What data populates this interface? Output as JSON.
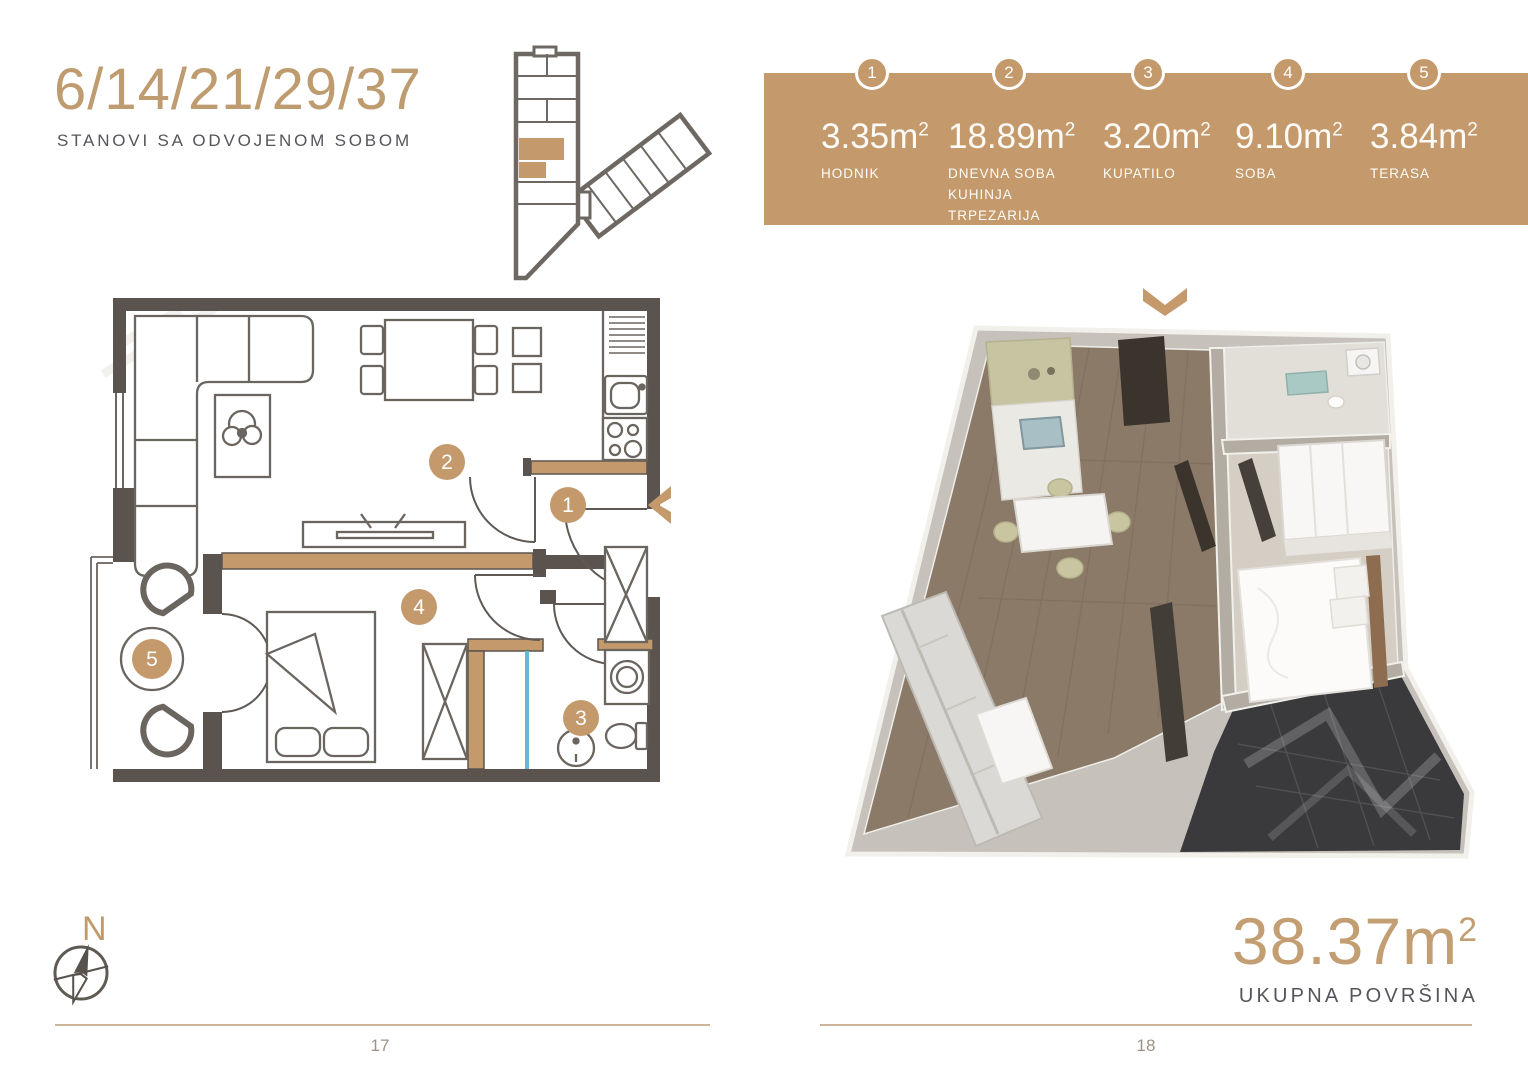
{
  "document": {
    "left_page": {
      "title": "6/14/21/29/37",
      "subtitle": "STANOVI SA ODVOJENOM SOBOM",
      "compass_label": "N",
      "page_number": "17"
    },
    "right_page": {
      "page_number": "18",
      "total_area": {
        "value": "38.37",
        "unit": "m",
        "sup": "2",
        "label": "UKUPNA POVRŠINA"
      }
    }
  },
  "legend": {
    "items": [
      {
        "num": "1",
        "value": "3.35",
        "unit": "m",
        "sup": "2",
        "lines": [
          "HODNIK"
        ]
      },
      {
        "num": "2",
        "value": "18.89",
        "unit": "m",
        "sup": "2",
        "lines": [
          "DNEVNA SOBA",
          "KUHINJA",
          "TRPEZARIJA"
        ]
      },
      {
        "num": "3",
        "value": "3.20",
        "unit": "m",
        "sup": "2",
        "lines": [
          "KUPATILO"
        ]
      },
      {
        "num": "4",
        "value": "9.10",
        "unit": "m",
        "sup": "2",
        "lines": [
          "SOBA"
        ]
      },
      {
        "num": "5",
        "value": "3.84",
        "unit": "m",
        "sup": "2",
        "lines": [
          "TERASA"
        ]
      }
    ]
  },
  "plan_badges": {
    "b1": "1",
    "b2": "2",
    "b3": "3",
    "b4": "4",
    "b5": "5"
  },
  "colors": {
    "accent": "#C49A6C",
    "wall": "#5B544E",
    "text_gray": "#57575A",
    "shower_glass": "#62B8D8",
    "rule": "#CDB59C"
  }
}
